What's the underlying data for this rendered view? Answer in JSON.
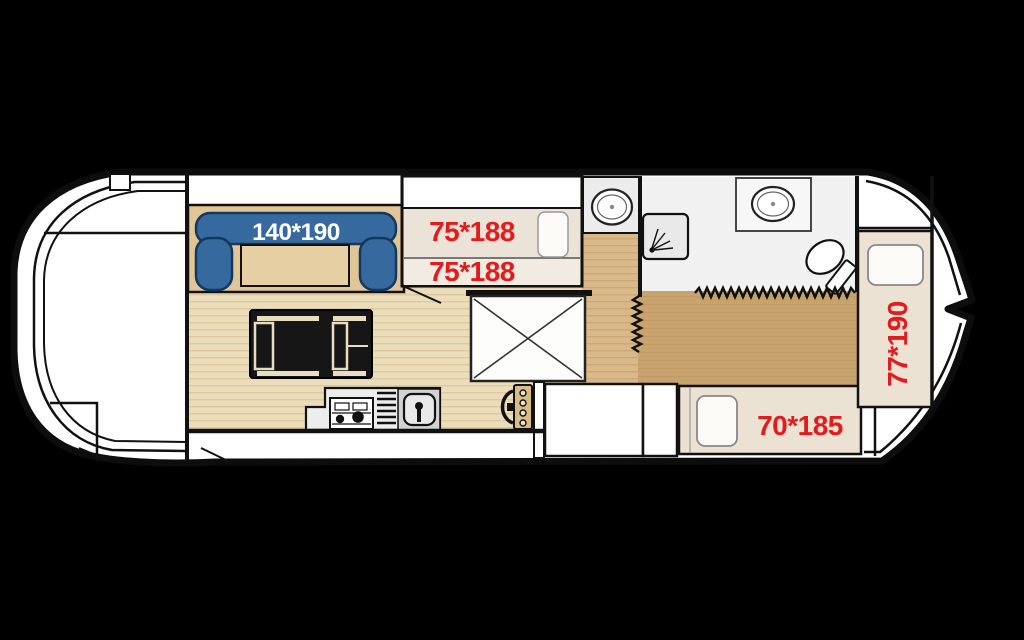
{
  "meta": {
    "type": "houseboat-floorplan-diagram"
  },
  "colors": {
    "background": "#000000",
    "hull_white": "#ffffff",
    "outline": "#111111",
    "label_red": "#e31b1d",
    "label_white": "#ffffff",
    "sofa_blue": "#36699e",
    "floor_light": "#ebdcba",
    "floor_mid": "#d9b98a",
    "floor_dark": "#c9a36e",
    "bed_cream": "#ebe2d4",
    "bathroom_gray": "#f1f1f1"
  },
  "dimension_labels": {
    "sofa_bed": "140*190",
    "bunk_bed_upper": "75*188",
    "bunk_bed_lower": "75*188",
    "cabin_bed": "70*185",
    "bow_bed": "77*190"
  },
  "symbols": [
    "sofa",
    "coffee-table",
    "lounge-chair",
    "galley-stove",
    "galley-drainer",
    "galley-sink",
    "helm-wheel",
    "drop-leaf-table",
    "washbasin",
    "shower",
    "toilet",
    "folding-door",
    "bunk-bed",
    "pillow",
    "wardrobe",
    "storage-cabinet",
    "stern-deck",
    "bow-deck"
  ]
}
